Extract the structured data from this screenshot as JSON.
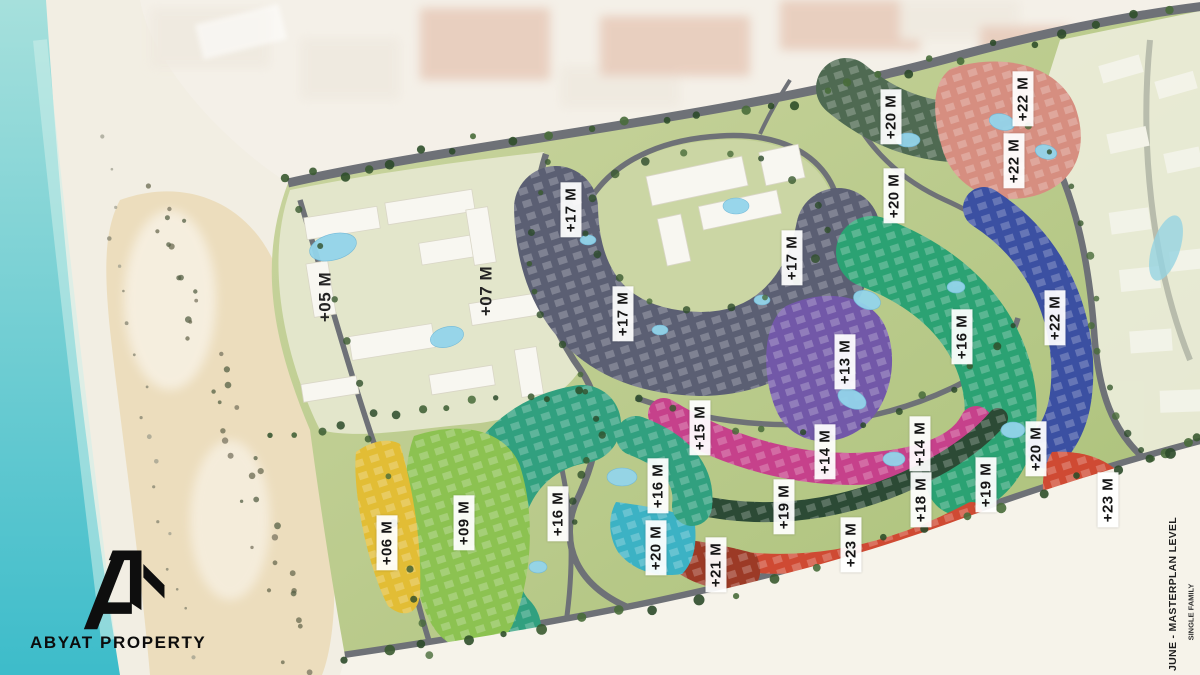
{
  "branding": {
    "logo_text": "ABYAT PROPERTY"
  },
  "side_note": {
    "title": "JUNE - MASTERPLAN LEVEL",
    "subtitle": "SINGLE FAMILY"
  },
  "palette": {
    "sea_light": "#a6e0dc",
    "sea_deep": "#3dbcca",
    "sea_streak": "#cdeeea",
    "sand": "#f2eee3",
    "sand_warm": "#e9d7ae",
    "sand_below": "#f6f3ea",
    "faded_strip": "#f3efe8",
    "faded_block_pink": "#e6c7b6",
    "faded_block_white": "#efe9df",
    "faded_right": "#ecedda",
    "site_green_light": "#ccd6a2",
    "site_green": "#a9c077",
    "park_green": "#cbd6a4",
    "road": "#6e7177",
    "faded_road": "#b9bcb0",
    "white_building": "#f8f7f1",
    "zone_white_residential": "#e3e6cb",
    "zone_slate_apartments": "#5b5f73",
    "zone_dark_green": "#4f6a52",
    "zone_salmon": "#d68e80",
    "zone_purple": "#7258a8",
    "zone_emerald": "#2ba273",
    "zone_blue": "#3b50a2",
    "zone_magenta": "#c6418b",
    "zone_forest": "#2c4a35",
    "zone_red": "#cf4a33",
    "zone_dark_red": "#9c3a26",
    "zone_teal": "#3cb2c4",
    "zone_sea_green": "#31a07f",
    "zone_light_green": "#8cc251",
    "zone_yellow": "#e2bd35",
    "pond": "#93d4ea",
    "tree": "#3a5a30",
    "label_text": "#161616",
    "label_bg": "#ffffff"
  },
  "labels": [
    {
      "text": "+05 M",
      "x": 325,
      "y": 297,
      "boxed": false
    },
    {
      "text": "+07 M",
      "x": 486,
      "y": 291,
      "boxed": false
    },
    {
      "text": "+17 M",
      "x": 571,
      "y": 210,
      "boxed": true
    },
    {
      "text": "+17 M",
      "x": 623,
      "y": 314,
      "boxed": true
    },
    {
      "text": "+17 M",
      "x": 792,
      "y": 258,
      "boxed": true
    },
    {
      "text": "+20 M",
      "x": 891,
      "y": 117,
      "boxed": true
    },
    {
      "text": "+20 M",
      "x": 894,
      "y": 196,
      "boxed": true
    },
    {
      "text": "+22 M",
      "x": 1023,
      "y": 99,
      "boxed": true
    },
    {
      "text": "+22 M",
      "x": 1014,
      "y": 161,
      "boxed": true
    },
    {
      "text": "+13 M",
      "x": 845,
      "y": 362,
      "boxed": true
    },
    {
      "text": "+16 M",
      "x": 962,
      "y": 337,
      "boxed": true
    },
    {
      "text": "+22 M",
      "x": 1055,
      "y": 318,
      "boxed": true
    },
    {
      "text": "+15 M",
      "x": 700,
      "y": 428,
      "boxed": true
    },
    {
      "text": "+14 M",
      "x": 825,
      "y": 452,
      "boxed": true
    },
    {
      "text": "+14 M",
      "x": 920,
      "y": 444,
      "boxed": true
    },
    {
      "text": "+16 M",
      "x": 658,
      "y": 486,
      "boxed": true
    },
    {
      "text": "+16 M",
      "x": 558,
      "y": 514,
      "boxed": true
    },
    {
      "text": "+09 M",
      "x": 464,
      "y": 523,
      "boxed": true
    },
    {
      "text": "+06 M",
      "x": 387,
      "y": 543,
      "boxed": true
    },
    {
      "text": "+20 M",
      "x": 656,
      "y": 548,
      "boxed": true
    },
    {
      "text": "+19 M",
      "x": 784,
      "y": 507,
      "boxed": true
    },
    {
      "text": "+21 M",
      "x": 716,
      "y": 565,
      "boxed": true
    },
    {
      "text": "+23 M",
      "x": 851,
      "y": 545,
      "boxed": true
    },
    {
      "text": "+18 M",
      "x": 921,
      "y": 500,
      "boxed": true
    },
    {
      "text": "+19 M",
      "x": 986,
      "y": 485,
      "boxed": true
    },
    {
      "text": "+20 M",
      "x": 1036,
      "y": 449,
      "boxed": true
    },
    {
      "text": "+23 M",
      "x": 1108,
      "y": 500,
      "boxed": true
    }
  ]
}
